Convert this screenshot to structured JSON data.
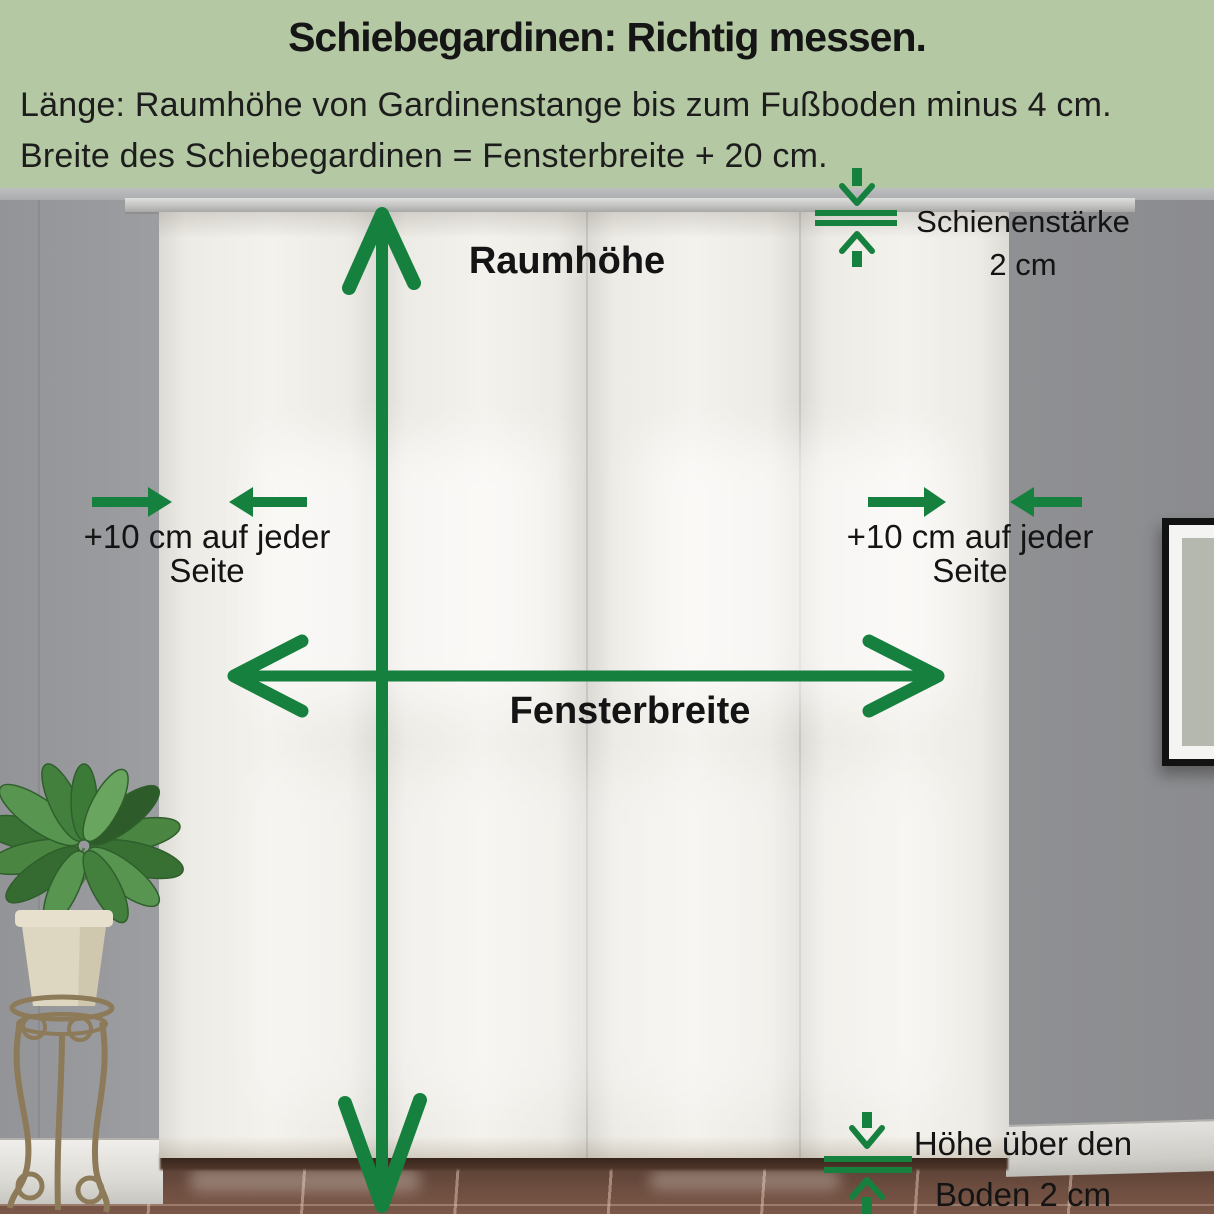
{
  "header": {
    "title": "Schiebegardinen: Richtig messen.",
    "instruction_line1": "Länge: Raumhöhe von Gardinenstange bis zum Fußboden minus 4 cm.",
    "instruction_line2": "Breite des Schiebegardinen = Fensterbreite + 20 cm.",
    "background_color": "#b4c9a3",
    "text_color": "#1d1d1d"
  },
  "annotations": {
    "arrow_color": "#16803e",
    "room_height": {
      "label": "Raumhöhe"
    },
    "rail_thickness": {
      "line1": "Schienenstärke",
      "line2": "2 cm"
    },
    "extra_left": {
      "line1": "+10 cm auf jeder",
      "line2": "Seite"
    },
    "extra_right": {
      "line1": "+10 cm auf jeder",
      "line2": "Seite"
    },
    "window_width": {
      "label": "Fensterbreite"
    },
    "floor_clearance": {
      "line1": "Höhe über den",
      "line2": "Boden 2 cm"
    }
  },
  "scene": {
    "curtain_panel_count": 4,
    "objects": [
      "sliding-curtain-panels",
      "curtain-rail",
      "potted-plant",
      "picture-frame",
      "tile-floor",
      "baseboard"
    ]
  }
}
